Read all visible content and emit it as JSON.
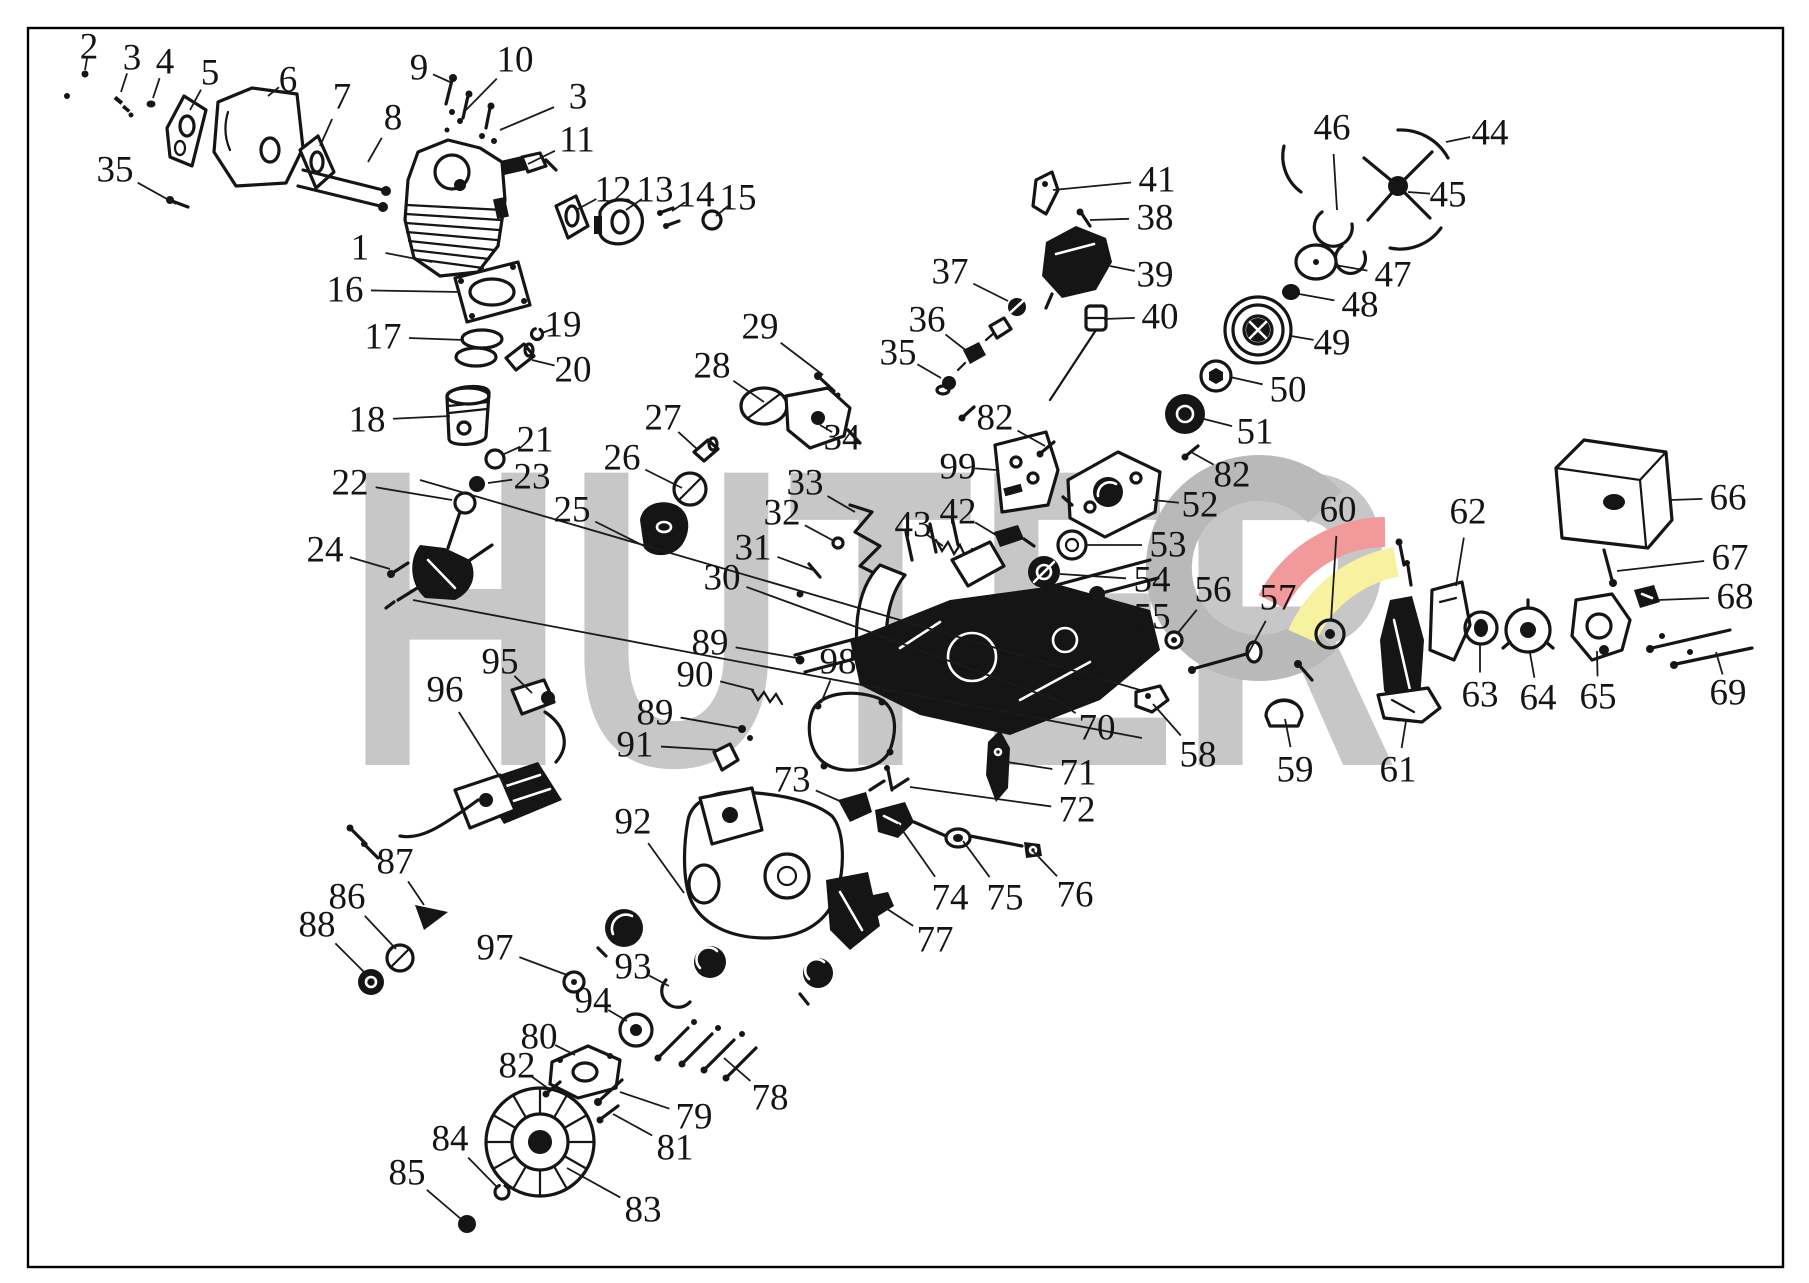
{
  "page": {
    "background": "#ffffff",
    "frame_color": "#000000"
  },
  "watermark": {
    "text": "HUTER",
    "color": "#c7c7c7",
    "logo": {
      "gray": "#b9b9b9",
      "red": "#f2999b",
      "yellow": "#f7f2a0"
    }
  },
  "diagram": {
    "type": "exploded-parts-diagram",
    "subject": "chainsaw",
    "callouts": [
      {
        "n": "1",
        "x": 360,
        "y": 248,
        "tx": 432,
        "ty": 262
      },
      {
        "n": "2",
        "x": 89,
        "y": 47,
        "tx": 85,
        "ty": 70
      },
      {
        "n": "3",
        "x": 132,
        "y": 58,
        "tx": 121,
        "ty": 92
      },
      {
        "n": "4",
        "x": 165,
        "y": 62,
        "tx": 153,
        "ty": 98
      },
      {
        "n": "5",
        "x": 210,
        "y": 73,
        "tx": 190,
        "ty": 110
      },
      {
        "n": "6",
        "x": 288,
        "y": 80,
        "tx": 268,
        "ty": 96
      },
      {
        "n": "7",
        "x": 342,
        "y": 97,
        "tx": 320,
        "ty": 146
      },
      {
        "n": "8",
        "x": 393,
        "y": 118,
        "tx": 368,
        "ty": 162
      },
      {
        "n": "9",
        "x": 419,
        "y": 68,
        "tx": 450,
        "ty": 82
      },
      {
        "n": "10",
        "x": 515,
        "y": 60,
        "tx": 466,
        "ty": 110
      },
      {
        "n": "3",
        "x": 578,
        "y": 97,
        "tx": 500,
        "ty": 130
      },
      {
        "n": "11",
        "x": 577,
        "y": 140,
        "tx": 528,
        "ty": 164
      },
      {
        "n": "12",
        "x": 613,
        "y": 190,
        "tx": 576,
        "ty": 210
      },
      {
        "n": "13",
        "x": 655,
        "y": 190,
        "tx": 626,
        "ty": 210
      },
      {
        "n": "14",
        "x": 696,
        "y": 195,
        "tx": 672,
        "ty": 211
      },
      {
        "n": "15",
        "x": 738,
        "y": 198,
        "tx": 716,
        "ty": 216
      },
      {
        "n": "16",
        "x": 345,
        "y": 290,
        "tx": 460,
        "ty": 292
      },
      {
        "n": "17",
        "x": 383,
        "y": 337,
        "tx": 464,
        "ty": 340
      },
      {
        "n": "18",
        "x": 367,
        "y": 420,
        "tx": 450,
        "ty": 416
      },
      {
        "n": "19",
        "x": 563,
        "y": 325,
        "tx": 542,
        "ty": 333
      },
      {
        "n": "20",
        "x": 573,
        "y": 370,
        "tx": 532,
        "ty": 360
      },
      {
        "n": "21",
        "x": 535,
        "y": 440,
        "tx": 502,
        "ty": 455
      },
      {
        "n": "22",
        "x": 350,
        "y": 483,
        "tx": 452,
        "ty": 500
      },
      {
        "n": "23",
        "x": 532,
        "y": 477,
        "tx": 488,
        "ty": 483
      },
      {
        "n": "24",
        "x": 325,
        "y": 550,
        "tx": 390,
        "ty": 569
      },
      {
        "n": "25",
        "x": 572,
        "y": 510,
        "tx": 648,
        "ty": 548
      },
      {
        "n": "26",
        "x": 622,
        "y": 458,
        "tx": 682,
        "ty": 488
      },
      {
        "n": "27",
        "x": 663,
        "y": 418,
        "tx": 697,
        "ty": 449
      },
      {
        "n": "28",
        "x": 712,
        "y": 366,
        "tx": 764,
        "ty": 402
      },
      {
        "n": "29",
        "x": 760,
        "y": 327,
        "tx": 823,
        "ty": 375
      },
      {
        "n": "30",
        "x": 722,
        "y": 578,
        "tx": 1056,
        "ty": 700
      },
      {
        "n": "31",
        "x": 753,
        "y": 548,
        "tx": 813,
        "ty": 570
      },
      {
        "n": "32",
        "x": 782,
        "y": 513,
        "tx": 834,
        "ty": 541
      },
      {
        "n": "33",
        "x": 805,
        "y": 483,
        "tx": 855,
        "ty": 512
      },
      {
        "n": "34",
        "x": 842,
        "y": 438,
        "tx": 820,
        "ty": 425
      },
      {
        "n": "35",
        "x": 115,
        "y": 170,
        "tx": 176,
        "ty": 204
      },
      {
        "n": "35",
        "x": 898,
        "y": 353,
        "tx": 941,
        "ty": 378
      },
      {
        "n": "36",
        "x": 927,
        "y": 320,
        "tx": 968,
        "ty": 352
      },
      {
        "n": "37",
        "x": 950,
        "y": 272,
        "tx": 1008,
        "ty": 301
      },
      {
        "n": "38",
        "x": 1155,
        "y": 218,
        "tx": 1090,
        "ty": 220
      },
      {
        "n": "39",
        "x": 1155,
        "y": 275,
        "tx": 1110,
        "ty": 266
      },
      {
        "n": "40",
        "x": 1160,
        "y": 317,
        "tx": 1104,
        "ty": 319
      },
      {
        "n": "41",
        "x": 1157,
        "y": 180,
        "tx": 1053,
        "ty": 190
      },
      {
        "n": "42",
        "x": 958,
        "y": 512,
        "tx": 996,
        "ty": 535
      },
      {
        "n": "43",
        "x": 913,
        "y": 525,
        "tx": 943,
        "ty": 546
      },
      {
        "n": "44",
        "x": 1490,
        "y": 133,
        "tx": 1446,
        "ty": 142
      },
      {
        "n": "45",
        "x": 1448,
        "y": 195,
        "tx": 1408,
        "ty": 192
      },
      {
        "n": "46",
        "x": 1332,
        "y": 128,
        "tx": 1337,
        "ty": 210
      },
      {
        "n": "47",
        "x": 1393,
        "y": 275,
        "tx": 1335,
        "ty": 265
      },
      {
        "n": "48",
        "x": 1360,
        "y": 305,
        "tx": 1299,
        "ty": 294
      },
      {
        "n": "49",
        "x": 1332,
        "y": 343,
        "tx": 1291,
        "ty": 336
      },
      {
        "n": "50",
        "x": 1288,
        "y": 390,
        "tx": 1230,
        "ty": 377
      },
      {
        "n": "51",
        "x": 1255,
        "y": 432,
        "tx": 1204,
        "ty": 419
      },
      {
        "n": "52",
        "x": 1200,
        "y": 505,
        "tx": 1153,
        "ty": 500
      },
      {
        "n": "53",
        "x": 1168,
        "y": 545,
        "tx": 1086,
        "ty": 545
      },
      {
        "n": "54",
        "x": 1152,
        "y": 580,
        "tx": 1060,
        "ty": 574
      },
      {
        "n": "55",
        "x": 1152,
        "y": 617,
        "tx": 1103,
        "ty": 597
      },
      {
        "n": "56",
        "x": 1213,
        "y": 590,
        "tx": 1177,
        "ty": 634
      },
      {
        "n": "57",
        "x": 1278,
        "y": 598,
        "tx": 1248,
        "ty": 654
      },
      {
        "n": "58",
        "x": 1198,
        "y": 755,
        "tx": 1153,
        "ty": 704
      },
      {
        "n": "59",
        "x": 1295,
        "y": 770,
        "tx": 1285,
        "ty": 719
      },
      {
        "n": "60",
        "x": 1338,
        "y": 510,
        "tx": 1331,
        "ty": 621
      },
      {
        "n": "61",
        "x": 1398,
        "y": 770,
        "tx": 1406,
        "ty": 721
      },
      {
        "n": "62",
        "x": 1468,
        "y": 512,
        "tx": 1456,
        "ty": 586
      },
      {
        "n": "63",
        "x": 1480,
        "y": 695,
        "tx": 1480,
        "ty": 645
      },
      {
        "n": "64",
        "x": 1538,
        "y": 698,
        "tx": 1530,
        "ty": 653
      },
      {
        "n": "65",
        "x": 1598,
        "y": 697,
        "tx": 1597,
        "ty": 651
      },
      {
        "n": "66",
        "x": 1728,
        "y": 498,
        "tx": 1671,
        "ty": 500
      },
      {
        "n": "67",
        "x": 1730,
        "y": 558,
        "tx": 1617,
        "ty": 571
      },
      {
        "n": "68",
        "x": 1735,
        "y": 597,
        "tx": 1658,
        "ty": 600
      },
      {
        "n": "69",
        "x": 1728,
        "y": 693,
        "tx": 1716,
        "ty": 652
      },
      {
        "n": "70",
        "x": 1097,
        "y": 728,
        "tx": 1048,
        "ty": 694
      },
      {
        "n": "71",
        "x": 1078,
        "y": 773,
        "tx": 1007,
        "ty": 762
      },
      {
        "n": "72",
        "x": 1077,
        "y": 810,
        "tx": 910,
        "ty": 787
      },
      {
        "n": "73",
        "x": 792,
        "y": 780,
        "tx": 851,
        "ty": 806
      },
      {
        "n": "74",
        "x": 950,
        "y": 898,
        "tx": 898,
        "ty": 824
      },
      {
        "n": "75",
        "x": 1005,
        "y": 898,
        "tx": 963,
        "ty": 841
      },
      {
        "n": "76",
        "x": 1075,
        "y": 895,
        "tx": 1033,
        "ty": 851
      },
      {
        "n": "77",
        "x": 935,
        "y": 940,
        "tx": 884,
        "ty": 907
      },
      {
        "n": "78",
        "x": 770,
        "y": 1098,
        "tx": 724,
        "ty": 1058
      },
      {
        "n": "79",
        "x": 694,
        "y": 1117,
        "tx": 620,
        "ty": 1092
      },
      {
        "n": "80",
        "x": 539,
        "y": 1037,
        "tx": 575,
        "ty": 1055
      },
      {
        "n": "81",
        "x": 675,
        "y": 1148,
        "tx": 613,
        "ty": 1114
      },
      {
        "n": "82",
        "x": 995,
        "y": 418,
        "tx": 1045,
        "ty": 446
      },
      {
        "n": "82",
        "x": 1232,
        "y": 475,
        "tx": 1191,
        "ty": 452
      },
      {
        "n": "82",
        "x": 517,
        "y": 1066,
        "tx": 549,
        "ty": 1089
      },
      {
        "n": "83",
        "x": 643,
        "y": 1210,
        "tx": 567,
        "ty": 1168
      },
      {
        "n": "84",
        "x": 450,
        "y": 1139,
        "tx": 497,
        "ty": 1187
      },
      {
        "n": "85",
        "x": 407,
        "y": 1173,
        "tx": 461,
        "ty": 1219
      },
      {
        "n": "86",
        "x": 347,
        "y": 897,
        "tx": 396,
        "ty": 949
      },
      {
        "n": "87",
        "x": 395,
        "y": 862,
        "tx": 424,
        "ty": 905
      },
      {
        "n": "88",
        "x": 317,
        "y": 925,
        "tx": 365,
        "ty": 973
      },
      {
        "n": "89",
        "x": 710,
        "y": 643,
        "tx": 797,
        "ty": 658
      },
      {
        "n": "90",
        "x": 695,
        "y": 675,
        "tx": 754,
        "ty": 690
      },
      {
        "n": "89",
        "x": 655,
        "y": 713,
        "tx": 739,
        "ty": 728
      },
      {
        "n": "91",
        "x": 635,
        "y": 745,
        "tx": 719,
        "ty": 750
      },
      {
        "n": "92",
        "x": 633,
        "y": 822,
        "tx": 684,
        "ty": 893
      },
      {
        "n": "93",
        "x": 633,
        "y": 967,
        "tx": 669,
        "ty": 986
      },
      {
        "n": "94",
        "x": 593,
        "y": 1001,
        "tx": 627,
        "ty": 1021
      },
      {
        "n": "95",
        "x": 500,
        "y": 662,
        "tx": 532,
        "ty": 693
      },
      {
        "n": "96",
        "x": 445,
        "y": 690,
        "tx": 508,
        "ty": 790
      },
      {
        "n": "97",
        "x": 495,
        "y": 948,
        "tx": 567,
        "ty": 975
      },
      {
        "n": "98",
        "x": 838,
        "y": 662,
        "tx": 821,
        "ty": 703
      },
      {
        "n": "99",
        "x": 958,
        "y": 467,
        "tx": 996,
        "ty": 470
      }
    ]
  }
}
